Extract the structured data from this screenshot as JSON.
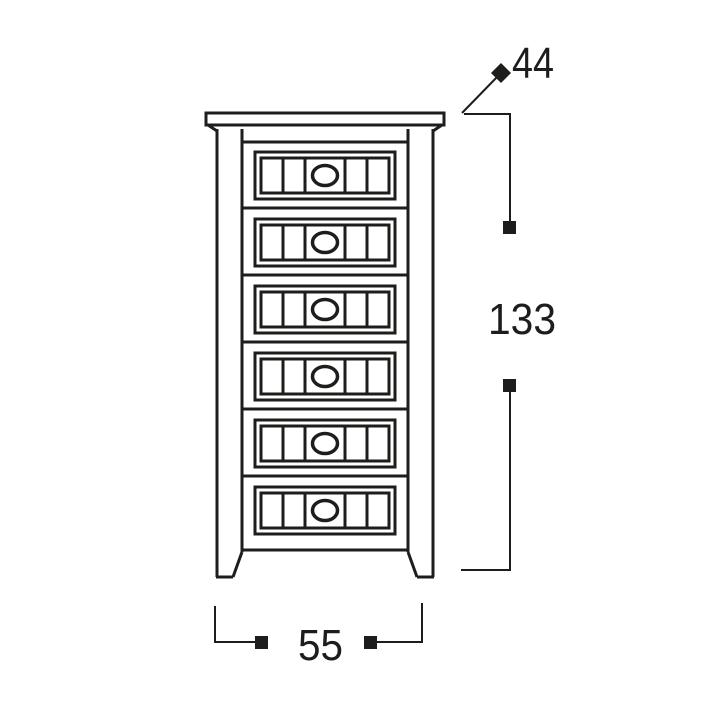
{
  "diagram": {
    "background": "#ffffff",
    "line_color": "#1d1d1b",
    "furniture": {
      "kind": "tall-chest-of-drawers",
      "drawer_count": 6
    },
    "dimensions": {
      "depth": {
        "value": "44",
        "marker": "diamond"
      },
      "height": {
        "value": "133",
        "marker": "square"
      },
      "width": {
        "value": "55",
        "marker": "square"
      }
    }
  }
}
